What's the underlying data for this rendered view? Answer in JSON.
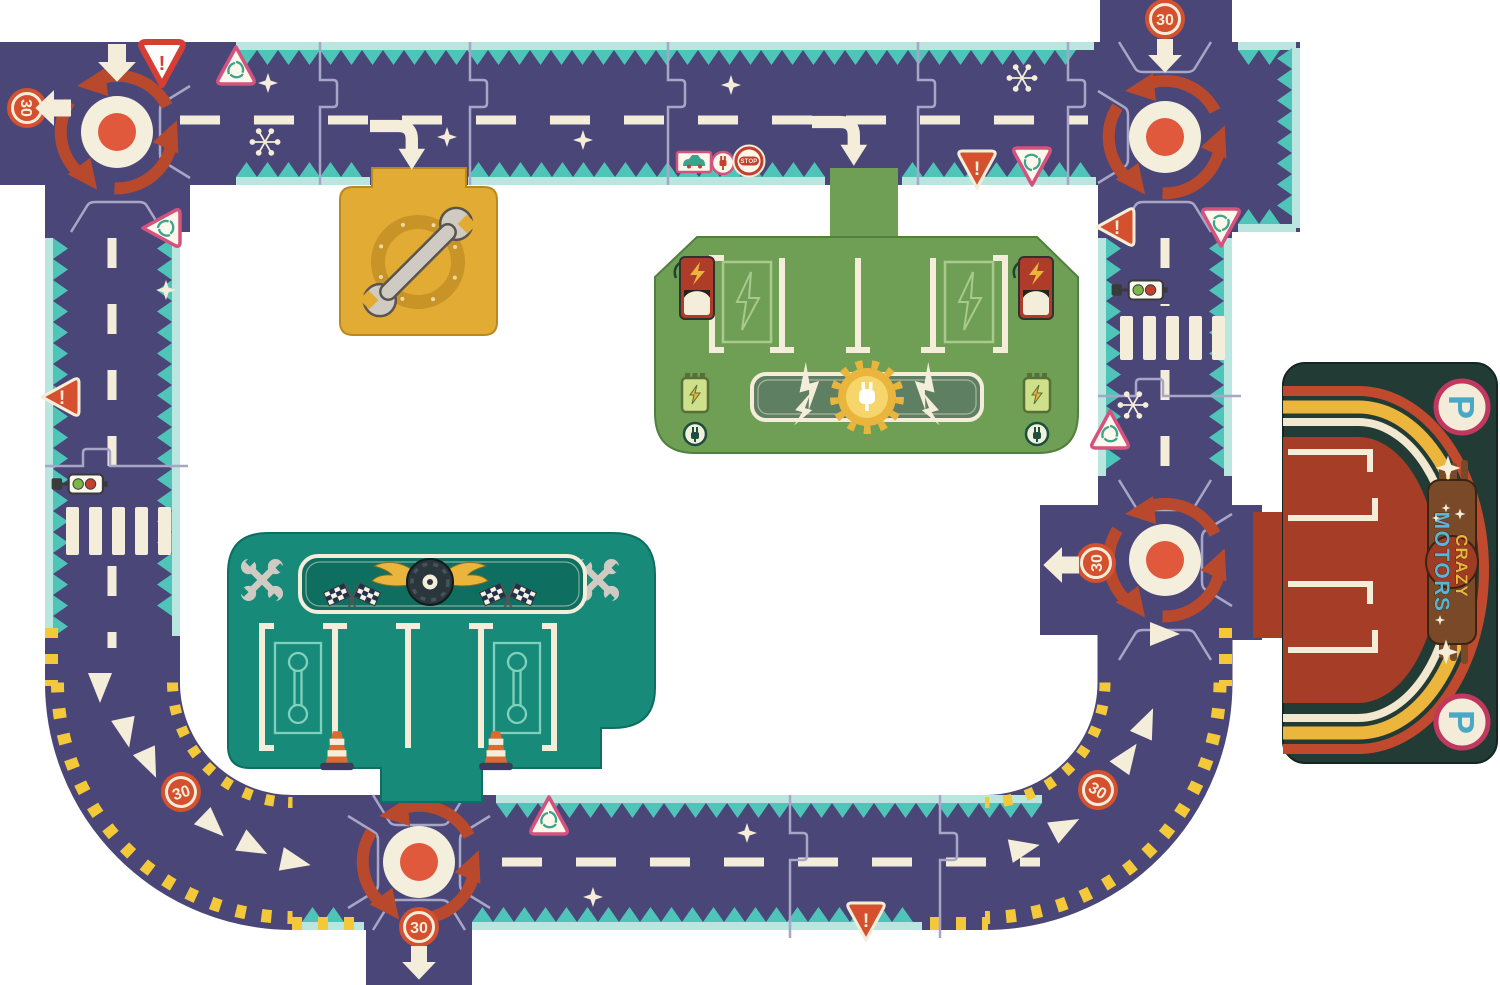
{
  "signs": {
    "speed_limit": "30",
    "stop": "STOP",
    "warning": "!",
    "parking": "P"
  },
  "branding": {
    "line1": "CRAZY",
    "line2": "MOTORS"
  },
  "icons": {
    "roundabout_marking": "circular-red-arrows",
    "speed_limit_badge": "30-circle-badge",
    "warning_sign": "exclamation-triangle",
    "roundabout_ahead_sign": "pink-triangle-roundabout",
    "stop_sign": "stop-circle",
    "car_sign": "car-plate",
    "plug_sign": "plug-circle",
    "traffic_light": "horizontal-traffic-light",
    "crosswalk": "zebra-stripes",
    "garage_emblem": "wrench-ring",
    "crossed_wrenches": "crossed-wrenches",
    "winged_tire": "tire-with-wings",
    "checkered_flags": "crossed-checkered-flags",
    "traffic_cone": "orange-cone",
    "charging_pump": "red-ev-pump",
    "battery": "green-battery",
    "plug_gear": "gear-with-plug",
    "lightning": "lightning-bolt",
    "chevron": "white-triangle-marking",
    "sparkle": "four-point-star",
    "snowflake": "six-spoke-flake",
    "block_arrow": "white-block-arrow",
    "curved_arrow": "white-elbow-arrow"
  },
  "colors": {
    "road": "#4a4678",
    "line_cream": "#f3edd9",
    "zigzag": "#4fc4b8",
    "zigzag_band": "#b9e7e0",
    "arrow_red": "#b8492c",
    "dot_orange": "#e0593c",
    "hazard_yellow": "#f3c93a",
    "sign_pink": "#d6527e",
    "sign_orange": "#d4502e",
    "sign_red": "#d43f35",
    "sign_icon_teal": "#3aa58c",
    "stop_red": "#c4402e",
    "gold": "#e2ab33",
    "gold_dark": "#c89428",
    "tool_grey": "#cfcbc3",
    "tool_grey_dark": "#5a544e",
    "station_green": "#6f9f54",
    "station_green_light": "#a9c98e",
    "pump_red": "#ae3c28",
    "battery_green": "#cfe08a",
    "garage_teal": "#178a7a",
    "banner_teal": "#0e6e60",
    "wrench_outline_teal": "#7fd0bd",
    "flag_navy": "#22304f",
    "tire_dark": "#2a363b",
    "wing_yellow": "#eab53c",
    "parking_bg": "#223b35",
    "parking_red": "#a63d26",
    "arc_red": "#c14a2e",
    "arc_yellow": "#ecb53c",
    "logo_blue": "#58b7d6",
    "logo_brown": "#7a4a28",
    "p_teal": "#4aa8c7",
    "p_ring": "#c0385e",
    "puzzle_line": "#a8a6c6",
    "traffic_green": "#7ab648",
    "traffic_red": "#c4402e"
  }
}
